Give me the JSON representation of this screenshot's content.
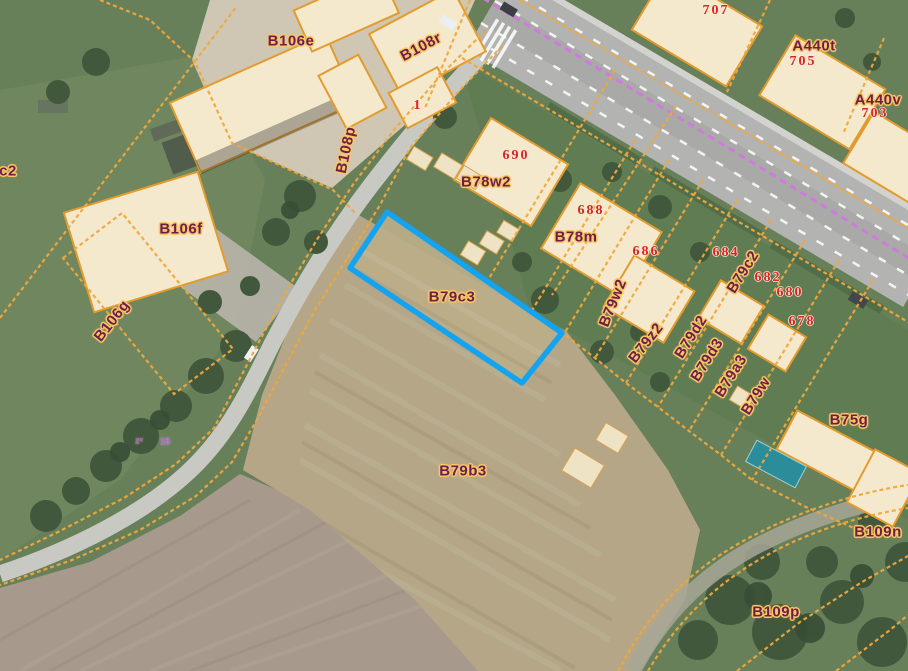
{
  "map": {
    "selected_parcel": {
      "id": "B79c3",
      "outline_color": "#14a3ef"
    },
    "colors": {
      "parcel_line": "#f1a83b",
      "parcel_label": "#6b1e4e",
      "parcel_label_halo": "#f8c763",
      "house_number": "#d6232e",
      "survey_marker": "#b95fd2",
      "road_centerline": "#d079de",
      "building_fill": "#f5e9cd",
      "building_stroke": "#e39b2d",
      "highlight_fill": "none"
    },
    "labels": [
      {
        "text": "c2",
        "x": 8,
        "y": 171,
        "rot": 0,
        "type": "parcel"
      },
      {
        "text": "B106e",
        "x": 291,
        "y": 41,
        "rot": 0,
        "type": "parcel"
      },
      {
        "text": "B108r",
        "x": 421,
        "y": 47,
        "rot": -28,
        "type": "parcel"
      },
      {
        "text": "B108p",
        "x": 346,
        "y": 150,
        "rot": -78,
        "type": "parcel"
      },
      {
        "text": "B106f",
        "x": 181,
        "y": 229,
        "rot": 0,
        "type": "parcel"
      },
      {
        "text": "B106g",
        "x": 112,
        "y": 321,
        "rot": -52,
        "type": "parcel"
      },
      {
        "text": "A440t",
        "x": 814,
        "y": 46,
        "rot": 0,
        "type": "parcel"
      },
      {
        "text": "A440v",
        "x": 878,
        "y": 100,
        "rot": 0,
        "type": "parcel"
      },
      {
        "text": "B78w2",
        "x": 486,
        "y": 182,
        "rot": 0,
        "type": "parcel"
      },
      {
        "text": "B78m",
        "x": 576,
        "y": 237,
        "rot": 0,
        "type": "parcel"
      },
      {
        "text": "B79w2",
        "x": 613,
        "y": 303,
        "rot": -68,
        "type": "parcel"
      },
      {
        "text": "B79c2",
        "x": 743,
        "y": 272,
        "rot": -58,
        "type": "parcel"
      },
      {
        "text": "B79z2",
        "x": 646,
        "y": 343,
        "rot": -52,
        "type": "parcel"
      },
      {
        "text": "B79d2",
        "x": 691,
        "y": 337,
        "rot": -58,
        "type": "parcel"
      },
      {
        "text": "B79d3",
        "x": 707,
        "y": 360,
        "rot": -58,
        "type": "parcel"
      },
      {
        "text": "B79a3",
        "x": 731,
        "y": 376,
        "rot": -58,
        "type": "parcel"
      },
      {
        "text": "B79w",
        "x": 756,
        "y": 396,
        "rot": -58,
        "type": "parcel"
      },
      {
        "text": "B79c3",
        "x": 452,
        "y": 297,
        "rot": 0,
        "type": "parcel"
      },
      {
        "text": "B79b3",
        "x": 463,
        "y": 471,
        "rot": 0,
        "type": "parcel"
      },
      {
        "text": "B75g",
        "x": 849,
        "y": 420,
        "rot": 0,
        "type": "parcel"
      },
      {
        "text": "B109n",
        "x": 878,
        "y": 532,
        "rot": 0,
        "type": "parcel"
      },
      {
        "text": "B109p",
        "x": 776,
        "y": 612,
        "rot": 0,
        "type": "parcel"
      },
      {
        "text": "1",
        "x": 418,
        "y": 106,
        "rot": 0,
        "type": "house"
      },
      {
        "text": "707",
        "x": 716,
        "y": 11,
        "rot": 0,
        "type": "house"
      },
      {
        "text": "705",
        "x": 803,
        "y": 62,
        "rot": 0,
        "type": "house"
      },
      {
        "text": "703",
        "x": 875,
        "y": 114,
        "rot": 0,
        "type": "house"
      },
      {
        "text": "690",
        "x": 516,
        "y": 156,
        "rot": 0,
        "type": "house"
      },
      {
        "text": "688",
        "x": 591,
        "y": 211,
        "rot": 0,
        "type": "house"
      },
      {
        "text": "686",
        "x": 646,
        "y": 252,
        "rot": 0,
        "type": "house"
      },
      {
        "text": "684",
        "x": 726,
        "y": 253,
        "rot": 0,
        "type": "house"
      },
      {
        "text": "682",
        "x": 768,
        "y": 278,
        "rot": 0,
        "type": "house"
      },
      {
        "text": "680",
        "x": 790,
        "y": 293,
        "rot": 0,
        "type": "house"
      },
      {
        "text": "678",
        "x": 802,
        "y": 322,
        "rot": 0,
        "type": "house"
      },
      {
        "text": "zᵛ",
        "x": 139,
        "y": 441,
        "rot": 0,
        "type": "marker"
      },
      {
        "text": "15",
        "x": 165,
        "y": 442,
        "rot": 0,
        "type": "marker"
      }
    ]
  }
}
